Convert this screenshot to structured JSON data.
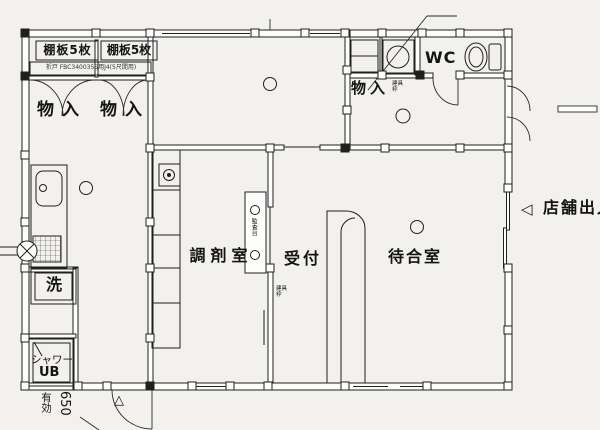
{
  "page": {
    "title": "店舗平面図",
    "bg_color": "#f3f1ee",
    "ink_color": "#1f1f1f"
  },
  "labels": {
    "shelf_left": "棚板5枚",
    "shelf_right": "棚板5枚",
    "door_spec": "折戸 FBC340035S用J4(5尺間用)",
    "closet_left": "物入",
    "closet_right": "物入",
    "storage_top": "物入",
    "fitting_frame_top": "建具枠",
    "wc": "WC",
    "wash": "洗",
    "shower": "シャワー",
    "unit_bath": "UB",
    "effective_label": "有効",
    "effective_value": "650",
    "dispensary": "調剤室",
    "inspection_counter": "監査台",
    "reception": "受付",
    "fitting_frame_mid": "建具枠",
    "waiting_room": "待合室",
    "entrance_arrow": "◁",
    "store_entrance": "店舗出入口",
    "triangle_marker": "△"
  }
}
